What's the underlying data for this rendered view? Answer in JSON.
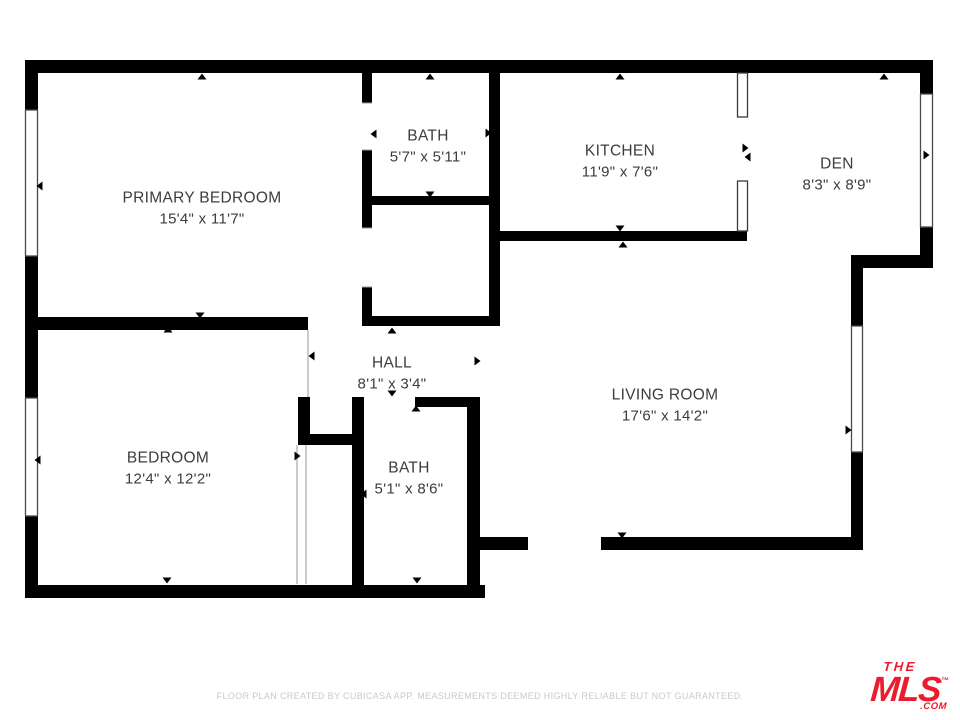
{
  "plan": {
    "wall_color": "#000000",
    "label_color": "#3c3c3c",
    "rooms": [
      {
        "id": "primary-bedroom",
        "name": "PRIMARY BEDROOM",
        "dims": "15'4\" x 11'7\""
      },
      {
        "id": "bath-upper",
        "name": "BATH",
        "dims": "5'7\" x 5'11\""
      },
      {
        "id": "kitchen",
        "name": "KITCHEN",
        "dims": "11'9\" x 7'6\""
      },
      {
        "id": "den",
        "name": "DEN",
        "dims": "8'3\" x 8'9\""
      },
      {
        "id": "hall",
        "name": "HALL",
        "dims": "8'1\" x 3'4\""
      },
      {
        "id": "living-room",
        "name": "LIVING ROOM",
        "dims": "17'6\" x 14'2\""
      },
      {
        "id": "bedroom",
        "name": "BEDROOM",
        "dims": "12'4\" x 12'2\""
      },
      {
        "id": "bath-lower",
        "name": "BATH",
        "dims": "5'1\" x 8'6\""
      }
    ]
  },
  "footer": {
    "disclaimer": "FLOOR PLAN CREATED BY CUBICASA APP. MEASUREMENTS DEEMED HIGHLY RELIABLE BUT NOT GUARANTEED."
  },
  "branding": {
    "logo_top": "THE",
    "logo_main": "MLS",
    "logo_tm": "™",
    "logo_suffix": ".COM",
    "logo_color": "#ed1b2e"
  }
}
